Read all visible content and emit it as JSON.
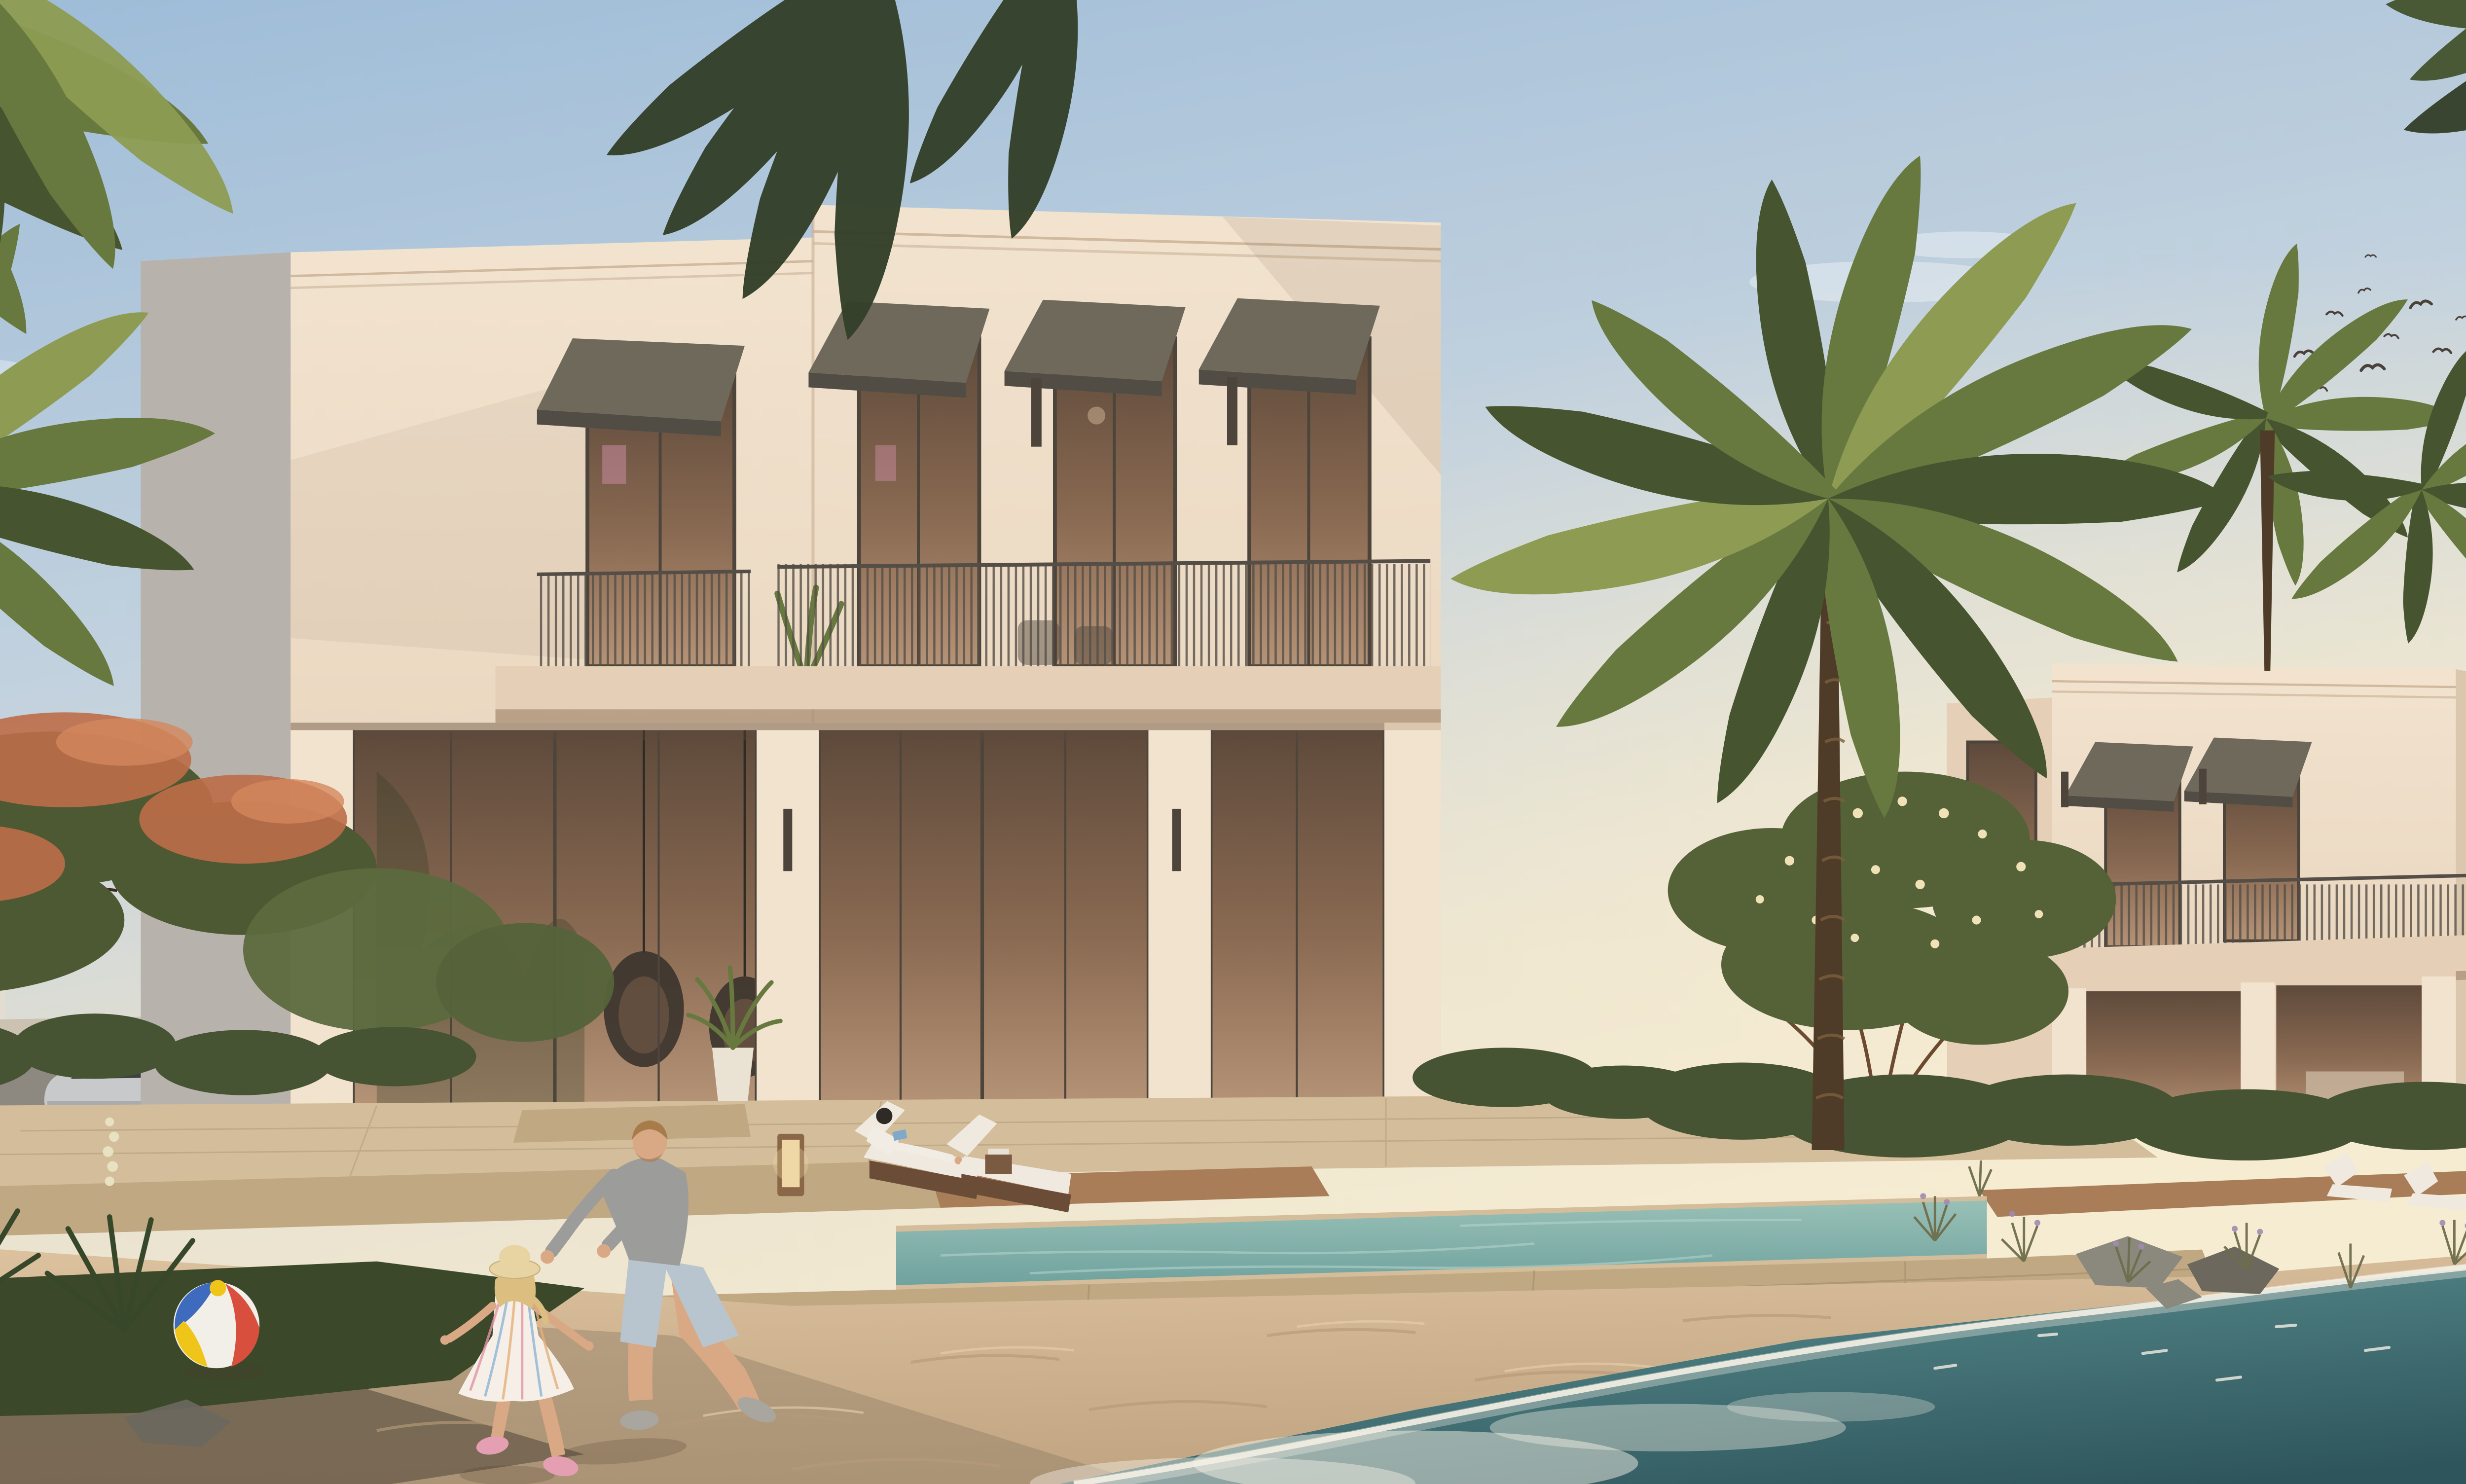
{
  "colors": {
    "sky_top": "#9cbbd8",
    "sky_mid": "#c3d2de",
    "sky_low": "#e9e2cf",
    "sky_glow": "#f6ecd2",
    "cloud": "#ffffff",
    "sea_deep": "#2e555c",
    "sea_mid": "#49797c",
    "sea_shore": "#8fb7ad",
    "foam": "#f3efe4",
    "sand_light": "#dfc4a1",
    "sand_mid": "#c2a683",
    "sand_shadow": "#70614f",
    "dune_line": "#b59a79",
    "dune_hi": "#e8d0ab",
    "stone_light": "#d3bd9a",
    "stone_mid": "#c0a883",
    "stone_dark": "#a98f6d",
    "wood_deck": "#a87d57",
    "pool_light": "#98c0b6",
    "pool_dark": "#6da09d",
    "pool_ripple": "#b6d6cd",
    "villa_lit": "#f2e3cf",
    "villa_lit2": "#e5d0b7",
    "villa_shade": "#b8b2ad",
    "villa_recess": "#dbc6ae",
    "cornice": "#c9b094",
    "slab_shadow": "#a98d73",
    "glass_warm": "#8a6a52",
    "glass_dark": "#5e4a3b",
    "glass_hi": "#b59377",
    "frame_dark": "#4d453b",
    "awning_top": "#6f695b",
    "awning_face": "#514d45",
    "rail_dark": "#544e46",
    "palm_dark": "#46552f",
    "palm_mid": "#67793f",
    "palm_light": "#8d9c52",
    "leaf_dark": "#34402a",
    "trunk_dark": "#4f3c28",
    "trunk_light": "#7a5f3c",
    "flame_green": "#4d5932",
    "flame_orange": "#bd6d48",
    "flame_orange2": "#d3875c",
    "hedge": "#465433",
    "lawn": "#3b492a",
    "yucca_green": "#37472a",
    "yucca_flower": "#e9e2c2",
    "plumeria_leaf": "#556238",
    "plumeria_flower": "#f1e1b6",
    "rock": "#8b887d",
    "rock_dark": "#6c685e",
    "street": "#8d8880",
    "curb": "#cbc2b2",
    "bldg_far": "#e3dcd0",
    "bldg_shade": "#c9c4bb",
    "suv_body": "#c7c9cb",
    "suv_dark": "#3f4143",
    "skin": "#d9a884",
    "hair_blond": "#a87c4a",
    "dad_shirt": "#9c9c9a",
    "dad_shorts": "#b8c5ce",
    "dad_shoe": "#a9a6a0",
    "girl_dress": "#f5efe7",
    "stripe_pink": "#e295a6",
    "stripe_blue": "#8fb5d6",
    "stripe_orange": "#e5b07a",
    "hat_straw": "#e7d4a2",
    "shoe_pink": "#e59fb2",
    "girl_hair": "#dcbf80",
    "woman_hair": "#2f2a26",
    "lounger_white": "#efe9df",
    "lounger_base": "#6b4d37",
    "lantern_glow": "#f0d8a6",
    "lantern_frame": "#8a6847",
    "table_wood": "#7a5a40",
    "ball_red": "#d94f3d",
    "ball_blue": "#3f6bbf",
    "ball_yellow": "#f0c519",
    "ball_white": "#f2efe8",
    "bird": "#4a423a",
    "shadow": "#4a3d2e"
  },
  "scene": {
    "sky": {
      "birds_count": 16,
      "clouds": "faint wisps",
      "light": "warm sunset glow at right horizon"
    },
    "background": {
      "left_buildings": 2,
      "far_right_building": 1,
      "street": true,
      "vehicle": "silver-suv",
      "gate_pillar": true
    },
    "main_villa": {
      "floors": 2,
      "upper_windows": 4,
      "awnings": 4,
      "balconies": 2,
      "wall_sconces": 4,
      "ground_glass_panels": 3,
      "hanging_chairs": 2,
      "potted_plant": 1
    },
    "second_villa": {
      "floors": 2,
      "upper_windows": 3,
      "awnings": 2,
      "balcony": 1,
      "white_loungers": 2
    },
    "landscape": {
      "palm_trees": 4,
      "overhanging_fronds": 3,
      "flame_tree_orange_blossoms": true,
      "plumeria_tree": true,
      "hedges": true,
      "yucca_flower_spikes": 3,
      "lawn": true,
      "rocks": true,
      "dune_grass": true
    },
    "pool_area": {
      "pool": true,
      "wicker_loungers": 2,
      "lantern": 1,
      "side_table": 1,
      "wood_deck": true,
      "travertine_terrace": true
    },
    "beach": {
      "sand": true,
      "sea": true,
      "foam_wave": true
    },
    "people": [
      {
        "name": "father",
        "appearance": "grey long-sleeve shirt, light blue shorts, crouching toward girl"
      },
      {
        "name": "girl",
        "appearance": "striped pastel dress, straw hat, pink sneakers, chasing ball"
      },
      {
        "name": "woman",
        "appearance": "white outfit, reading on pool lounger"
      }
    ],
    "props": {
      "beach_ball_colors": [
        "blue",
        "yellow",
        "red",
        "white"
      ]
    }
  }
}
